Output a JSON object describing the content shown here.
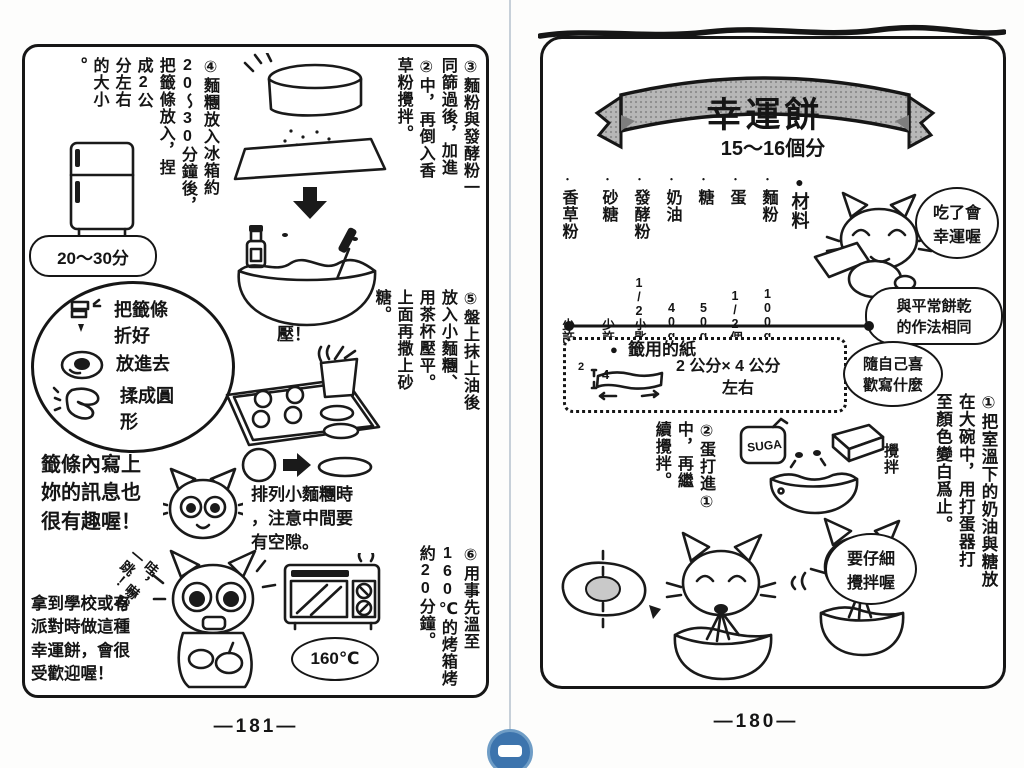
{
  "viewer": {
    "page_number_left": "—181—",
    "page_number_right": "—180—"
  },
  "left_page": {
    "step3": {
      "cols": [
        "③麵粉與發酵粉一",
        "同篩過後，加進",
        "②中，再倒入香",
        "草粉攪拌。"
      ]
    },
    "step4": {
      "cols": [
        "④麵糰放入冰箱約",
        "20～30分鐘後，",
        "把籤條放入，捏",
        "成2公",
        "分左右",
        "的大小",
        "。"
      ]
    },
    "fridge_bubble": "20～30分",
    "cloud": {
      "fold": "把籤條\n折好",
      "put": "放進去",
      "roll": "揉成圓\n形"
    },
    "note_message": "籤條內寫上\n妳的訊息也\n很有趣喔！",
    "step5": {
      "cols": [
        "⑤盤上抹上油後",
        "放入小麵糰、",
        "用茶杯壓平。",
        "上面再撒上砂",
        "糖。"
      ]
    },
    "press_label": "壓！",
    "note_spacing": "排列小麵糰時\n，注意中間要\n有空隙。",
    "step6": {
      "cols": [
        "⑥用事先溫至",
        "160℃的烤箱烤",
        "約20分鐘。"
      ]
    },
    "oven_bubble": "160℃",
    "scare_text": "哇，嚇我\n一跳！",
    "note_party": "拿到學校或有\n派對時做這種\n幸運餅，會很\n受歡迎喔！"
  },
  "right_page": {
    "title": "幸運餅",
    "yield": "15～16個分",
    "materials": {
      "bullet": "●",
      "label": "材料",
      "dot": "・"
    },
    "ingredients": [
      {
        "name": "麵粉",
        "amount": "100g"
      },
      {
        "name": "蛋",
        "amount": "1/2個"
      },
      {
        "name": "糖",
        "amount": "50g"
      },
      {
        "name": "奶油",
        "amount": "40g"
      },
      {
        "name": "發酵粉",
        "amount": "1/2小匙"
      },
      {
        "name": "砂糖",
        "amount": "少許"
      },
      {
        "name": "香草粉",
        "amount": "少許"
      }
    ],
    "bubble_lucky": "吃了會\n幸運喔",
    "bubble_same": "與平常餅乾\n的作法相同",
    "paper": {
      "bullet": "●",
      "label": "籤用的紙",
      "size": "2 公分× 4 公分",
      "size2": "左右",
      "dim_w": "4",
      "dim_h": "2"
    },
    "bubble_write": "隨自己喜\n歡寫什麼",
    "step1": {
      "cols": [
        "①把室溫下的奶油與糖放",
        "在大碗中，用打蛋器打",
        "至顏色變白爲止。"
      ]
    },
    "step2": {
      "cols": [
        "②蛋打進①",
        "中，再繼",
        "續攪拌。"
      ]
    },
    "stir_label": "攪拌",
    "sugar_label": "SUGA",
    "bubble_stir": "要仔細\n攪拌喔"
  }
}
